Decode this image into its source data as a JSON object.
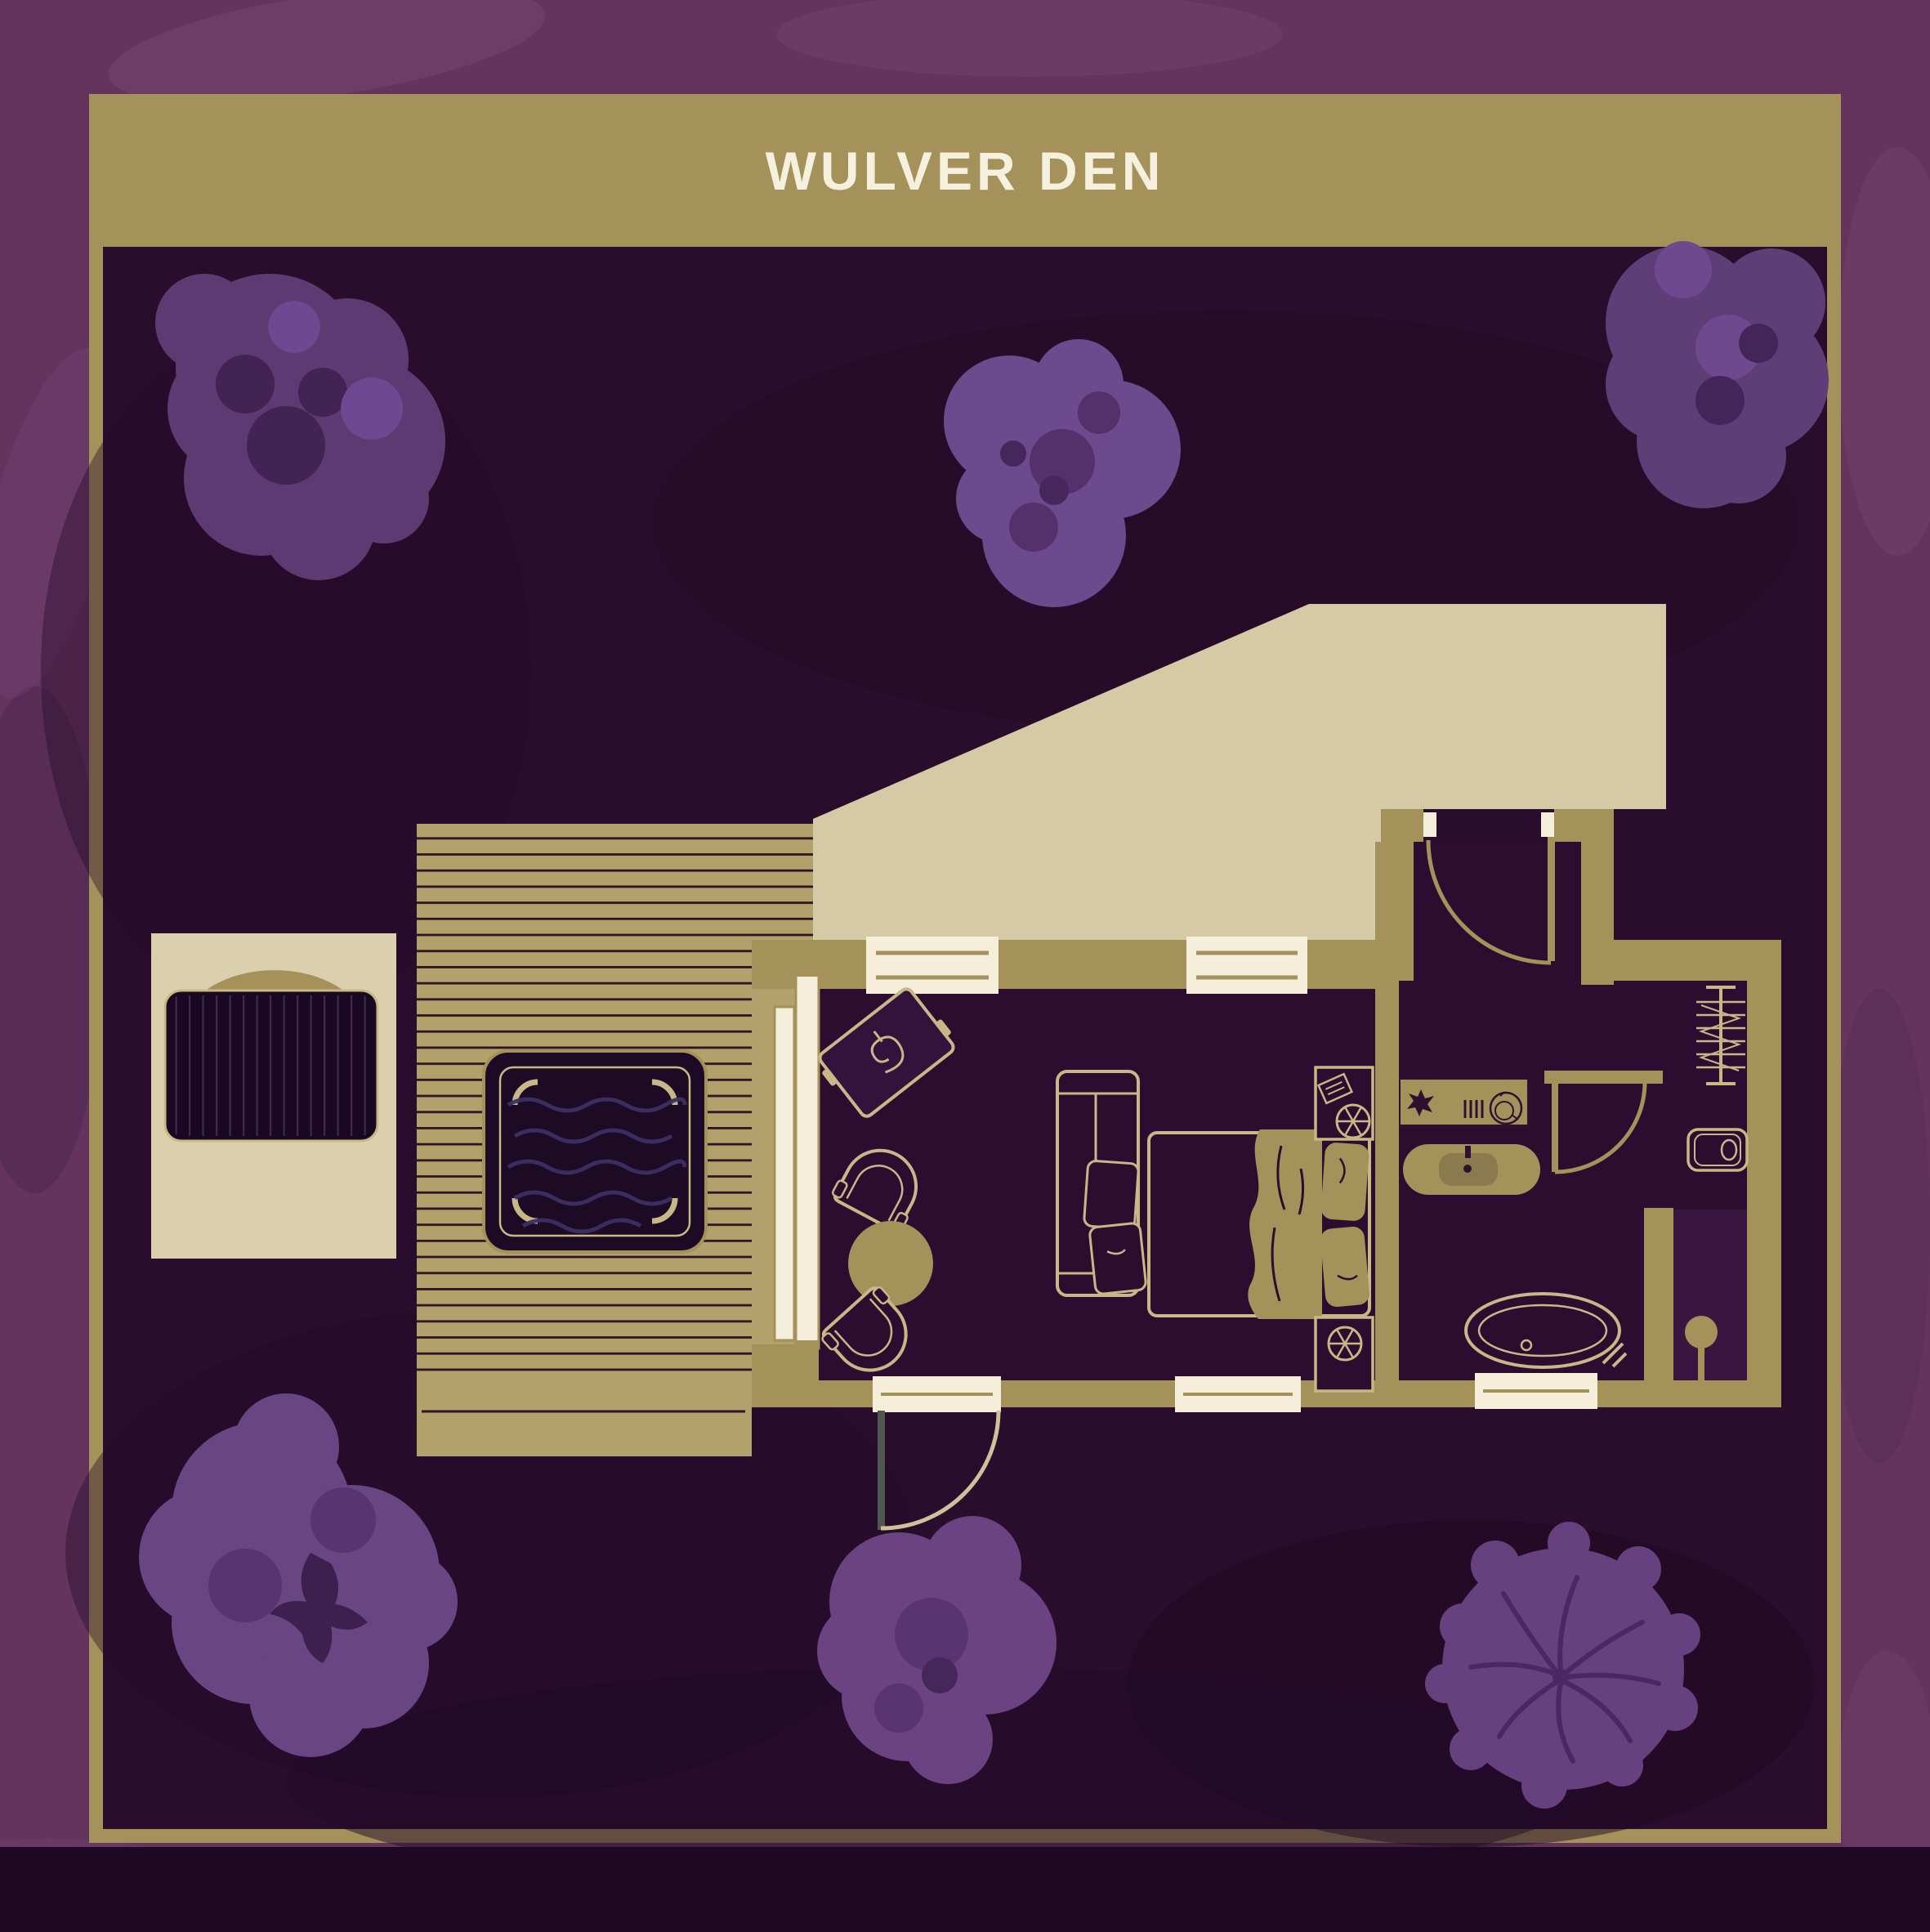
{
  "header": {
    "title": "WULVER DEN"
  },
  "palette": {
    "margin_purple": "#64345e",
    "panel_purple": "#2a0d2c",
    "frame_gold": "#a5915a",
    "roof_beige": "#d6c9a6",
    "deck_gold": "#b2a16a",
    "hut_beige": "#dbcfae",
    "furniture_line_gold": "#c8b787",
    "window_white": "#f4eedb",
    "tree_purple": "#6a4583",
    "title_text": "#f6f1df",
    "bottom_band": "#1f0824"
  },
  "floor_plan": {
    "areas": [
      "entrance-porch",
      "living-area",
      "bedroom",
      "bathroom",
      "shower",
      "wardrobe-nook",
      "deck",
      "hot-tub",
      "wood-store-hut",
      "roof-overhang"
    ],
    "furniture_icons": [
      "log-burner",
      "armchair",
      "side-table",
      "sofa",
      "double-bed",
      "duvet",
      "pillows",
      "nightstand",
      "reading-lamp",
      "book",
      "vanity-counter",
      "plant",
      "radiator",
      "towel-dish",
      "sink",
      "tap",
      "toilet",
      "bathtub",
      "bath-tap",
      "shower-head",
      "clothes-rail",
      "coat-hangers",
      "sliding-glass-door",
      "entrance-door",
      "bathroom-door",
      "terrace-door",
      "window"
    ],
    "decor": {
      "tree_clusters": 6
    }
  }
}
